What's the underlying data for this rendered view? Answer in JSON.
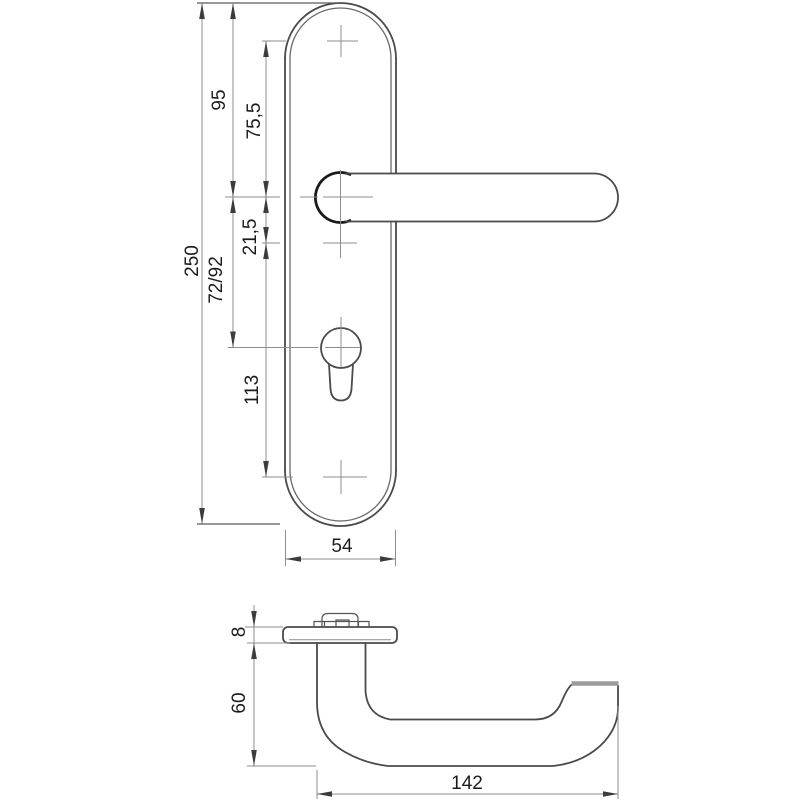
{
  "drawing": {
    "type": "technical-dimension-drawing",
    "subject": "door-handle-with-long-backplate",
    "background_color": "#ffffff",
    "outline_color": "#4a4a4a",
    "thin_line_color": "#8e8e8e",
    "text_color": "#1c1c1c"
  },
  "dimensions": {
    "front": [
      {
        "id": "overall-height",
        "value": "250"
      },
      {
        "id": "plate-top-to-handle-axis",
        "value": "95"
      },
      {
        "id": "upper-screw-to-handle-axis",
        "value": "75,5"
      },
      {
        "id": "handle-axis-to-spindle-mark",
        "value": "21,5"
      },
      {
        "id": "handle-axis-to-cylinder-axis",
        "value": "72/92"
      },
      {
        "id": "spindle-mark-to-lower-screw",
        "value": "113"
      },
      {
        "id": "plate-width",
        "value": "54"
      }
    ],
    "side": [
      {
        "id": "rose-thickness",
        "value": "8"
      },
      {
        "id": "handle-projection",
        "value": "60"
      },
      {
        "id": "handle-length",
        "value": "142"
      }
    ]
  }
}
